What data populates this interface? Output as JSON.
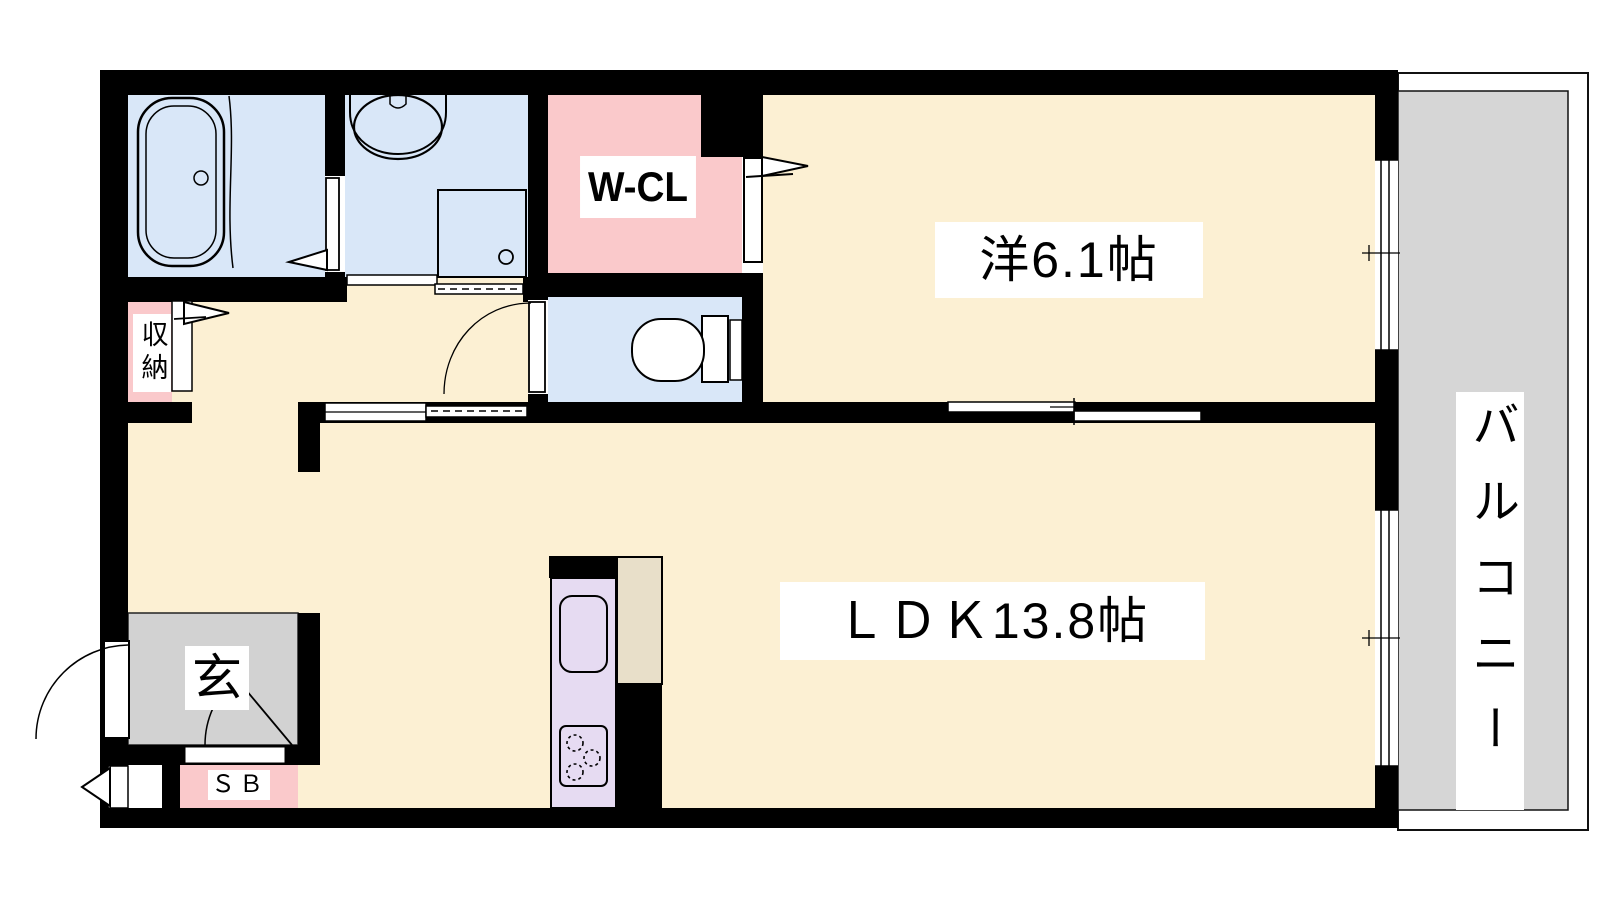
{
  "floorplan": {
    "rooms": {
      "western_room": "洋6.1帖",
      "ldk": "ＬＤＫ13.8帖",
      "walk_in_closet": "W-CL",
      "balcony": "バルコニー",
      "storage": "収納",
      "entrance": "玄",
      "shoe_box": "ＳＢ"
    },
    "colors": {
      "floor_cream": "#FCF0D3",
      "wet_area_blue": "#D9E7F8",
      "closet_pink": "#FAC9CB",
      "balcony_gray": "#D6D6D6",
      "genkan_gray": "#D2D2D2",
      "kitchen_lavender": "#E6DBF2",
      "appliance_tan": "#E8DFC9",
      "wall_black": "#000000"
    },
    "fixtures": [
      "bathtub",
      "washbasin",
      "washing-machine-space",
      "toilet",
      "kitchen-sink",
      "gas-stove",
      "refrigerator-space"
    ]
  }
}
